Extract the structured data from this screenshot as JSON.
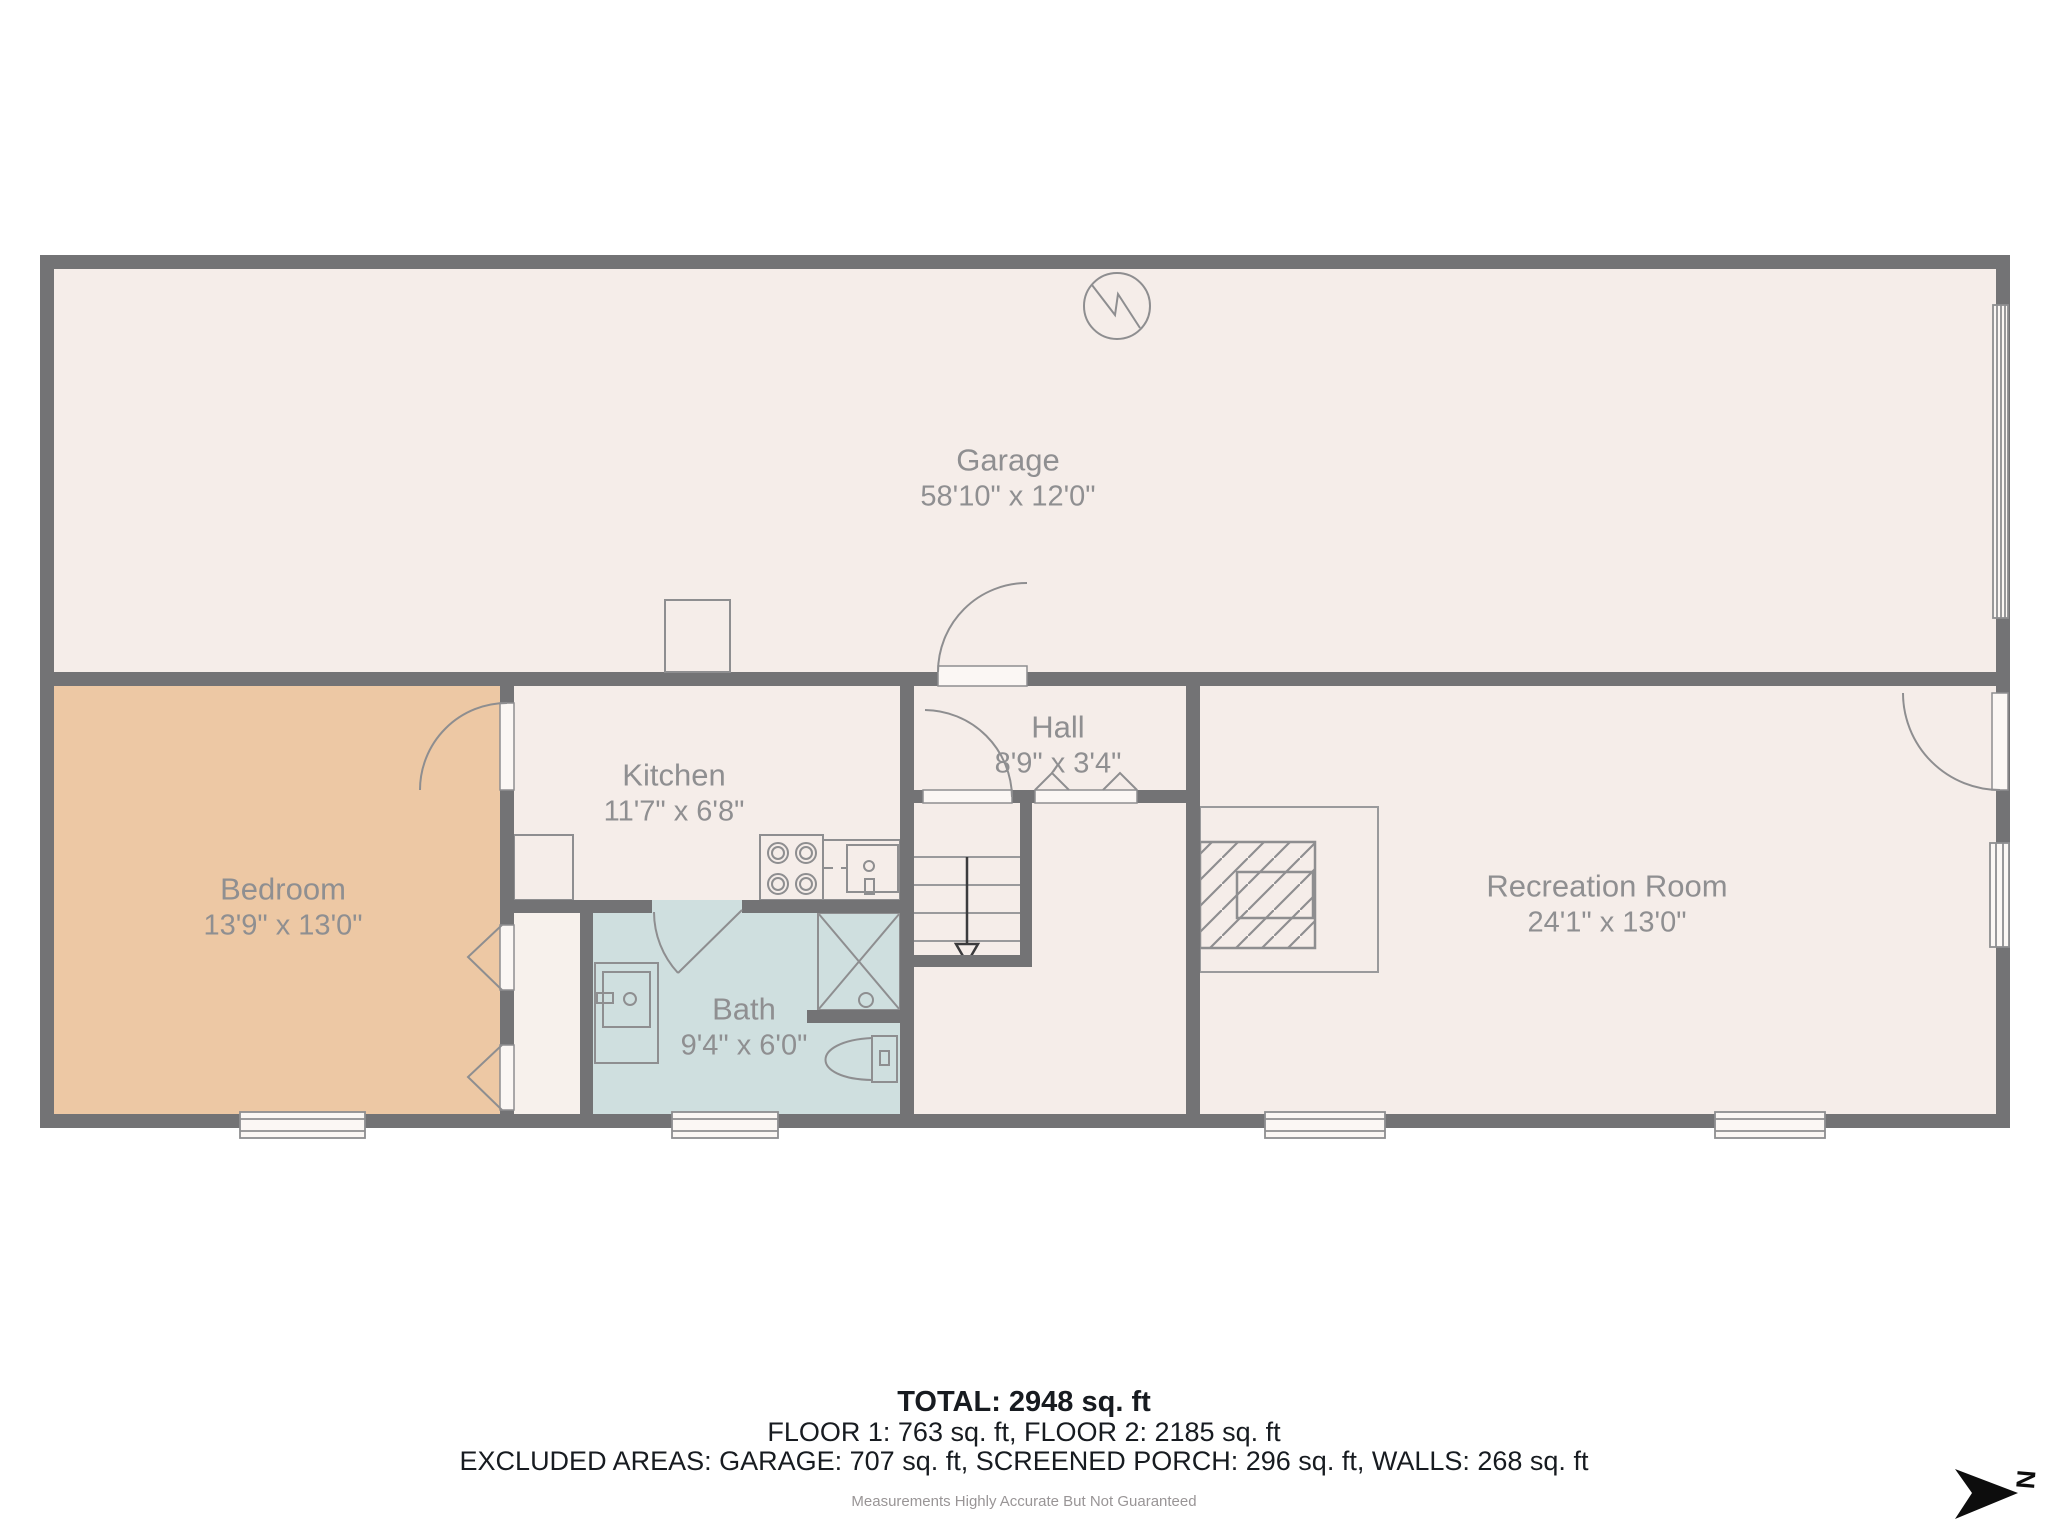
{
  "rooms": [
    {
      "id": "garage",
      "name": "Garage",
      "dims": "58'10\" x 12'0\""
    },
    {
      "id": "bedroom",
      "name": "Bedroom",
      "dims": "13'9\" x 13'0\""
    },
    {
      "id": "kitchen",
      "name": "Kitchen",
      "dims": "11'7\" x 6'8\""
    },
    {
      "id": "hall",
      "name": "Hall",
      "dims": "8'9\" x 3'4\""
    },
    {
      "id": "bath",
      "name": "Bath",
      "dims": "9'4\" x 6'0\""
    },
    {
      "id": "recreation",
      "name": "Recreation Room",
      "dims": "24'1\" x 13'0\""
    }
  ],
  "summary": {
    "total": "TOTAL: 2948 sq. ft",
    "floors": "FLOOR 1: 763 sq. ft, FLOOR 2: 2185 sq. ft",
    "excluded": "EXCLUDED AREAS: GARAGE: 707 sq. ft, SCREENED PORCH: 296 sq. ft, WALLS: 268 sq. ft",
    "disclaimer": "Measurements Highly Accurate But Not Guaranteed"
  },
  "compass": {
    "label": "N"
  },
  "colors": {
    "wall": "#737375",
    "floor": "#f5ede9",
    "bedroom_fill": "#edc8a4",
    "bath_fill": "#cfdfdf",
    "label_text": "#8f8f91",
    "summary_text": "#171b20",
    "fixture_line": "#8e8e90"
  }
}
